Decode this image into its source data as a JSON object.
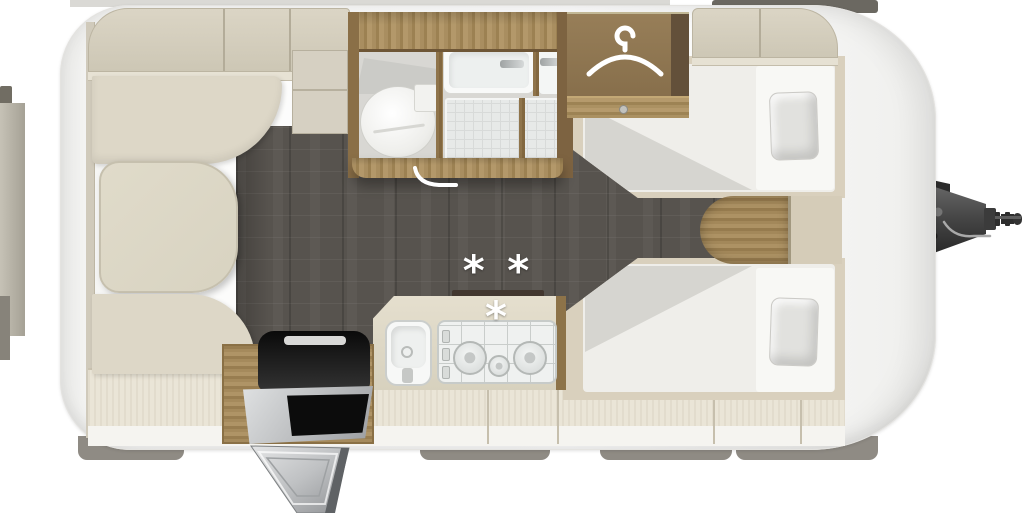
{
  "scene": {
    "description": "Caravan floor plan, top-down interior view",
    "stove_marking": "* * *"
  },
  "colors": {
    "body_white": "#fdfdfc",
    "furniture_beige": "#d9d3c3",
    "upholstery_beige": "#ddd7c7",
    "floor_dark": "#57534e",
    "wood_brown": "#a2875a",
    "mattress_white": "#efeeea",
    "pillow_grey": "#e1e1de",
    "appliance_black": "#1a1a1a",
    "metal_grey": "#c9cbcc",
    "hitch_grey": "#4a4a4a",
    "skirt_grey": "#8f8b84",
    "marking_white": "#ffffff"
  },
  "areas": {
    "front_lounge": "dinette with table and two bench seats",
    "overhead_lockers": "overhead storage lockers",
    "bathroom": "washroom with toilet, washbasin and shower",
    "wardrobe": "wardrobe with clothes rail",
    "kitchen": "kitchen with sink and gas hob",
    "cool_box": "top-opening cool box with exterior access flap",
    "bedroom": "twin single beds with pillows",
    "drawbar": "A-frame tow hitch"
  },
  "counts": {
    "hob_burners": 3,
    "beds": 2,
    "skirt_segments": 4,
    "asterisks": 3
  },
  "icons": [
    "hanger-icon",
    "door-swing-icon",
    "tow-hitch-icon",
    "asterisk-marking"
  ]
}
